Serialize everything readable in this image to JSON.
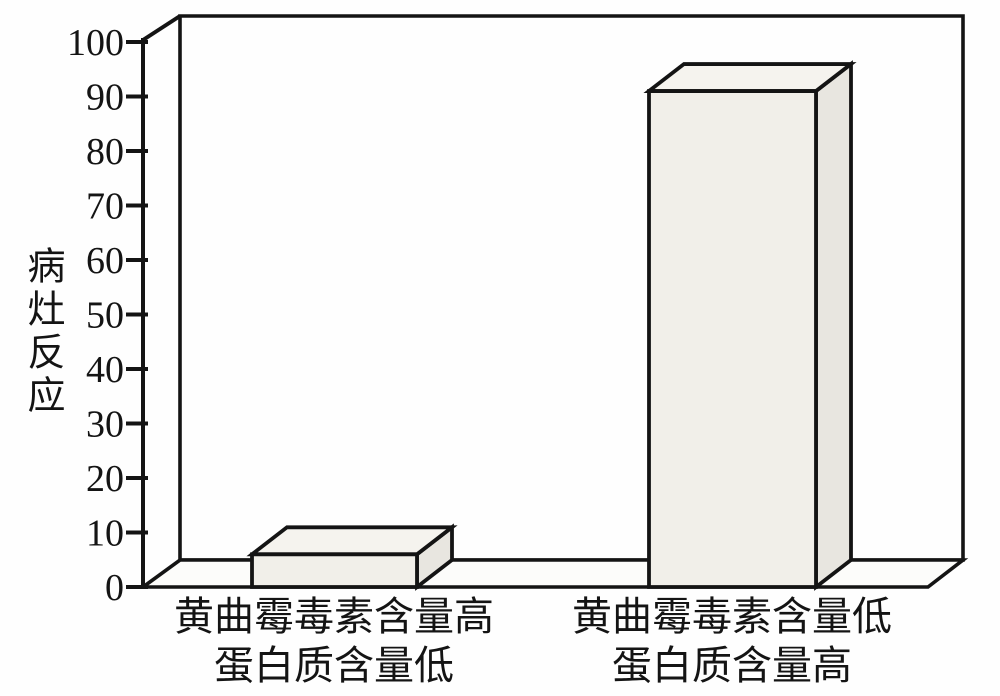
{
  "chart_data": {
    "type": "bar",
    "projection": "3d",
    "title": "",
    "xlabel": "",
    "ylabel": "病灶反应",
    "categories": [
      {
        "line1": "黄曲霉毒素含量高",
        "line2": "蛋白质含量低"
      },
      {
        "line1": "黄曲霉毒素含量低",
        "line2": "蛋白质含量高"
      }
    ],
    "values": [
      6,
      91
    ],
    "ylim": [
      0,
      100
    ],
    "ytick_step": 10,
    "ytick_labels": [
      "0",
      "10",
      "20",
      "30",
      "40",
      "50",
      "60",
      "70",
      "80",
      "90",
      "100"
    ],
    "grid": false,
    "legend": false,
    "colors": {
      "background": "#fefefe",
      "outline": "#141414",
      "wall_fill": "#fefefe",
      "floor_fill": "#fcfcfa",
      "bar_front": "#f1efe9",
      "bar_top": "#f5f3ee",
      "bar_side": "#e8e6e0"
    }
  }
}
